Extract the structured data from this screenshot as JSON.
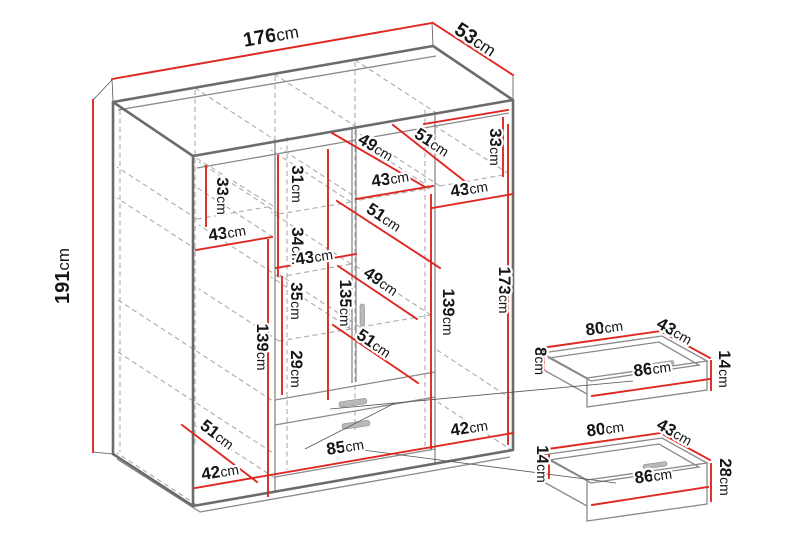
{
  "unit": "cm",
  "colors": {
    "dimension_line": "#df2721",
    "edge_gray": "#6b6b6b",
    "hidden_line_gray": "#ababab",
    "label_text": "#151515",
    "background": "#ffffff"
  },
  "wardrobe": {
    "overall": [
      {
        "id": "width",
        "n": "176",
        "u": "cm"
      },
      {
        "id": "depth",
        "n": "53",
        "u": "cm"
      },
      {
        "id": "height",
        "n": "191",
        "u": "cm"
      }
    ],
    "internal": [
      {
        "id": "left-top-section-height",
        "n": "33",
        "u": "cm"
      },
      {
        "id": "left-column-width",
        "n": "43",
        "u": "cm"
      },
      {
        "id": "mid-left-gap-1",
        "n": "31",
        "u": "cm"
      },
      {
        "id": "mid-left-gap-2",
        "n": "34",
        "u": "cm"
      },
      {
        "id": "shelf-diagonal-upper-1",
        "n": "49",
        "u": "cm"
      },
      {
        "id": "shelf-diagonal-upper-2",
        "n": "51",
        "u": "cm"
      },
      {
        "id": "right-top-section-height",
        "n": "33",
        "u": "cm"
      },
      {
        "id": "mid-right-column-width",
        "n": "43",
        "u": "cm"
      },
      {
        "id": "shelf-diagonal-mid",
        "n": "51",
        "u": "cm"
      },
      {
        "id": "right-column-width",
        "n": "43",
        "u": "cm"
      },
      {
        "id": "mid-left-column-width",
        "n": "43",
        "u": "cm"
      },
      {
        "id": "mid-left-gap-3",
        "n": "35",
        "u": "cm"
      },
      {
        "id": "middle-door-height",
        "n": "135",
        "u": "cm"
      },
      {
        "id": "shelf-diagonal-lower-1",
        "n": "49",
        "u": "cm"
      },
      {
        "id": "mid-right-door-height",
        "n": "139",
        "u": "cm"
      },
      {
        "id": "right-door-height",
        "n": "173",
        "u": "cm"
      },
      {
        "id": "left-lower-section-height",
        "n": "139",
        "u": "cm"
      },
      {
        "id": "mid-left-gap-4",
        "n": "29",
        "u": "cm"
      },
      {
        "id": "shelf-diagonal-lower-2",
        "n": "51",
        "u": "cm"
      },
      {
        "id": "left-bottom-diagonal",
        "n": "51",
        "u": "cm"
      },
      {
        "id": "bottom-left-width",
        "n": "42",
        "u": "cm"
      },
      {
        "id": "drawer-front-width",
        "n": "85",
        "u": "cm"
      },
      {
        "id": "bottom-right-width",
        "n": "42",
        "u": "cm"
      }
    ]
  },
  "drawer_top": {
    "labels": [
      {
        "id": "top-width",
        "n": "80",
        "u": "cm"
      },
      {
        "id": "depth",
        "n": "43",
        "u": "cm"
      },
      {
        "id": "back-height",
        "n": "8",
        "u": "cm"
      },
      {
        "id": "front-height",
        "n": "14",
        "u": "cm"
      },
      {
        "id": "front-width",
        "n": "86",
        "u": "cm"
      }
    ]
  },
  "drawer_bottom": {
    "labels": [
      {
        "id": "top-width",
        "n": "80",
        "u": "cm"
      },
      {
        "id": "depth",
        "n": "43",
        "u": "cm"
      },
      {
        "id": "back-height",
        "n": "14",
        "u": "cm"
      },
      {
        "id": "front-height",
        "n": "28",
        "u": "cm"
      },
      {
        "id": "front-width",
        "n": "86",
        "u": "cm"
      }
    ]
  }
}
